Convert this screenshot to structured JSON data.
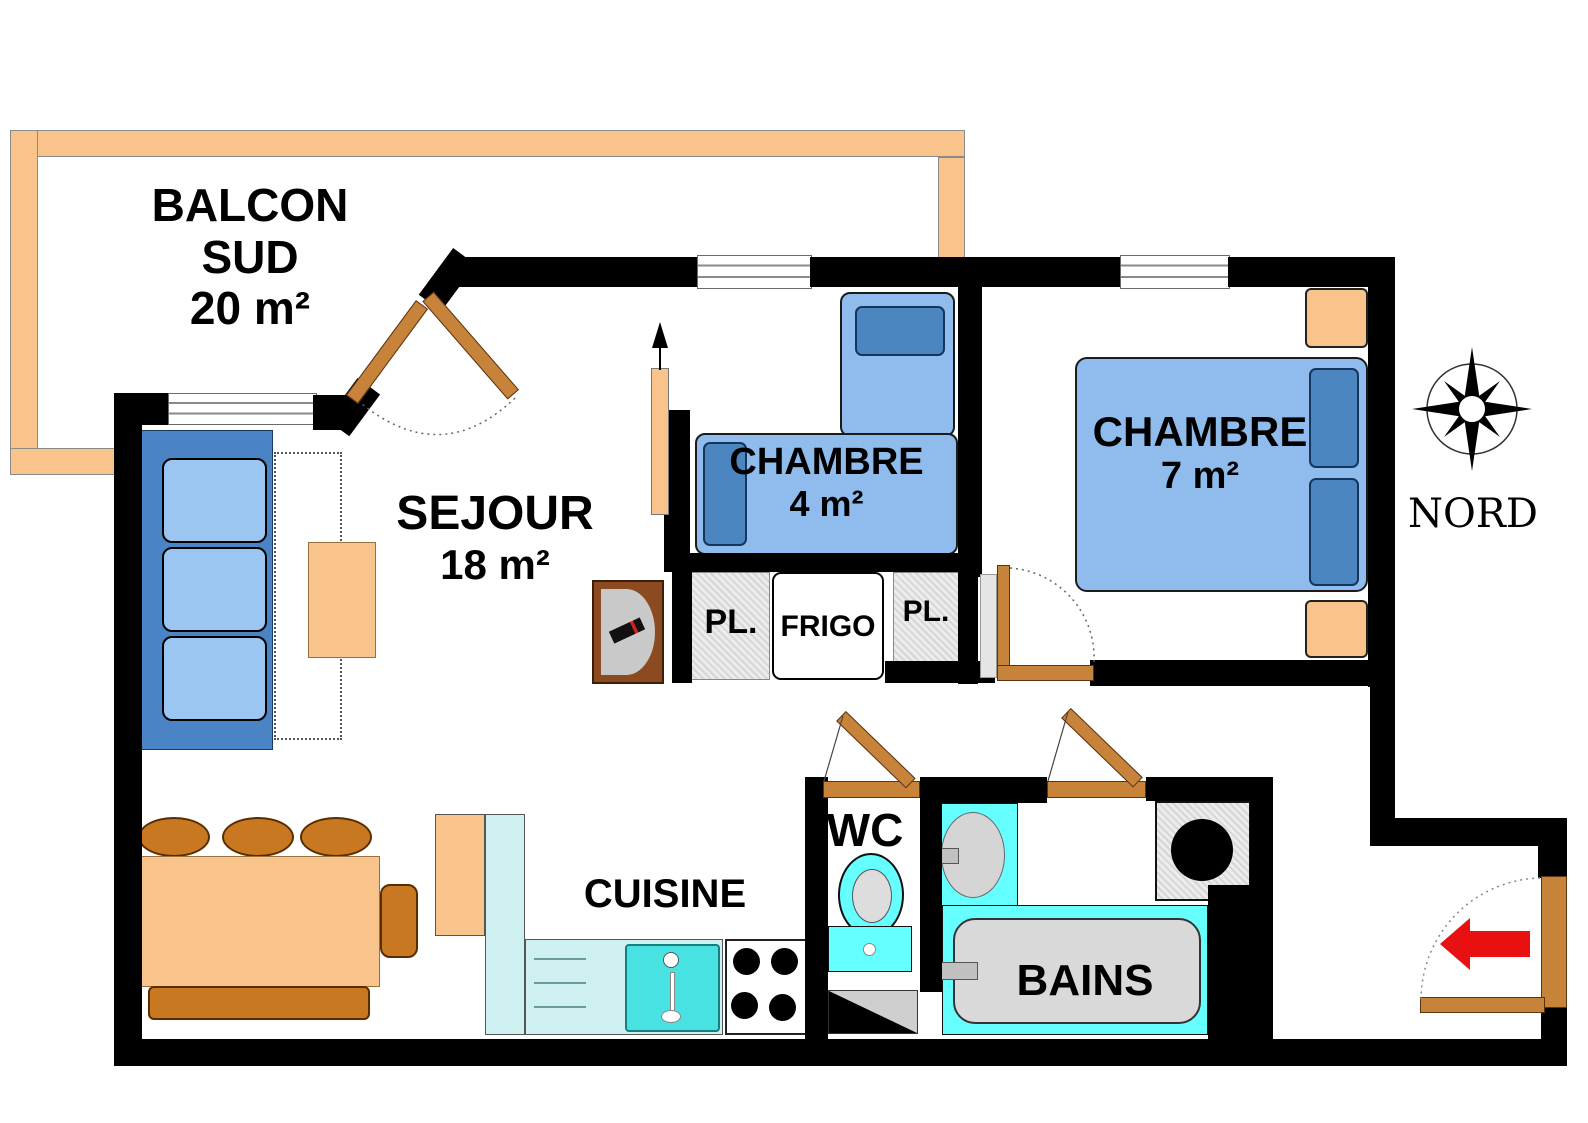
{
  "rooms": {
    "balcony": {
      "line1": "BALCON",
      "line2": "SUD",
      "line3": "20 m²"
    },
    "sejour": {
      "name": "SEJOUR",
      "area": "18 m²"
    },
    "chambre4": {
      "name": "CHAMBRE",
      "area": "4 m²"
    },
    "chambre7": {
      "name": "CHAMBRE",
      "area": "7 m²"
    },
    "cuisine": {
      "name": "CUISINE"
    },
    "wc": {
      "name": "WC"
    },
    "bains": {
      "name": "BAINS"
    }
  },
  "storage": {
    "closet_left": "PL.",
    "fridge": "FRIGO",
    "closet_right": "PL."
  },
  "compass": {
    "label": "NORD"
  },
  "colors": {
    "wall": "#000000",
    "balcony_rail": "#F8C48C",
    "wood_light": "#F8C48C",
    "wood_dark": "#C87820",
    "door": "#C8833A",
    "bed_light": "#8FBCEC",
    "bed_dark": "#4C86C0",
    "fixture_cyan": "#66FFFF",
    "counter_cyan": "#CFF0F0",
    "fixture_gray": "#D9D9D9",
    "arrow_red": "#E81010"
  }
}
